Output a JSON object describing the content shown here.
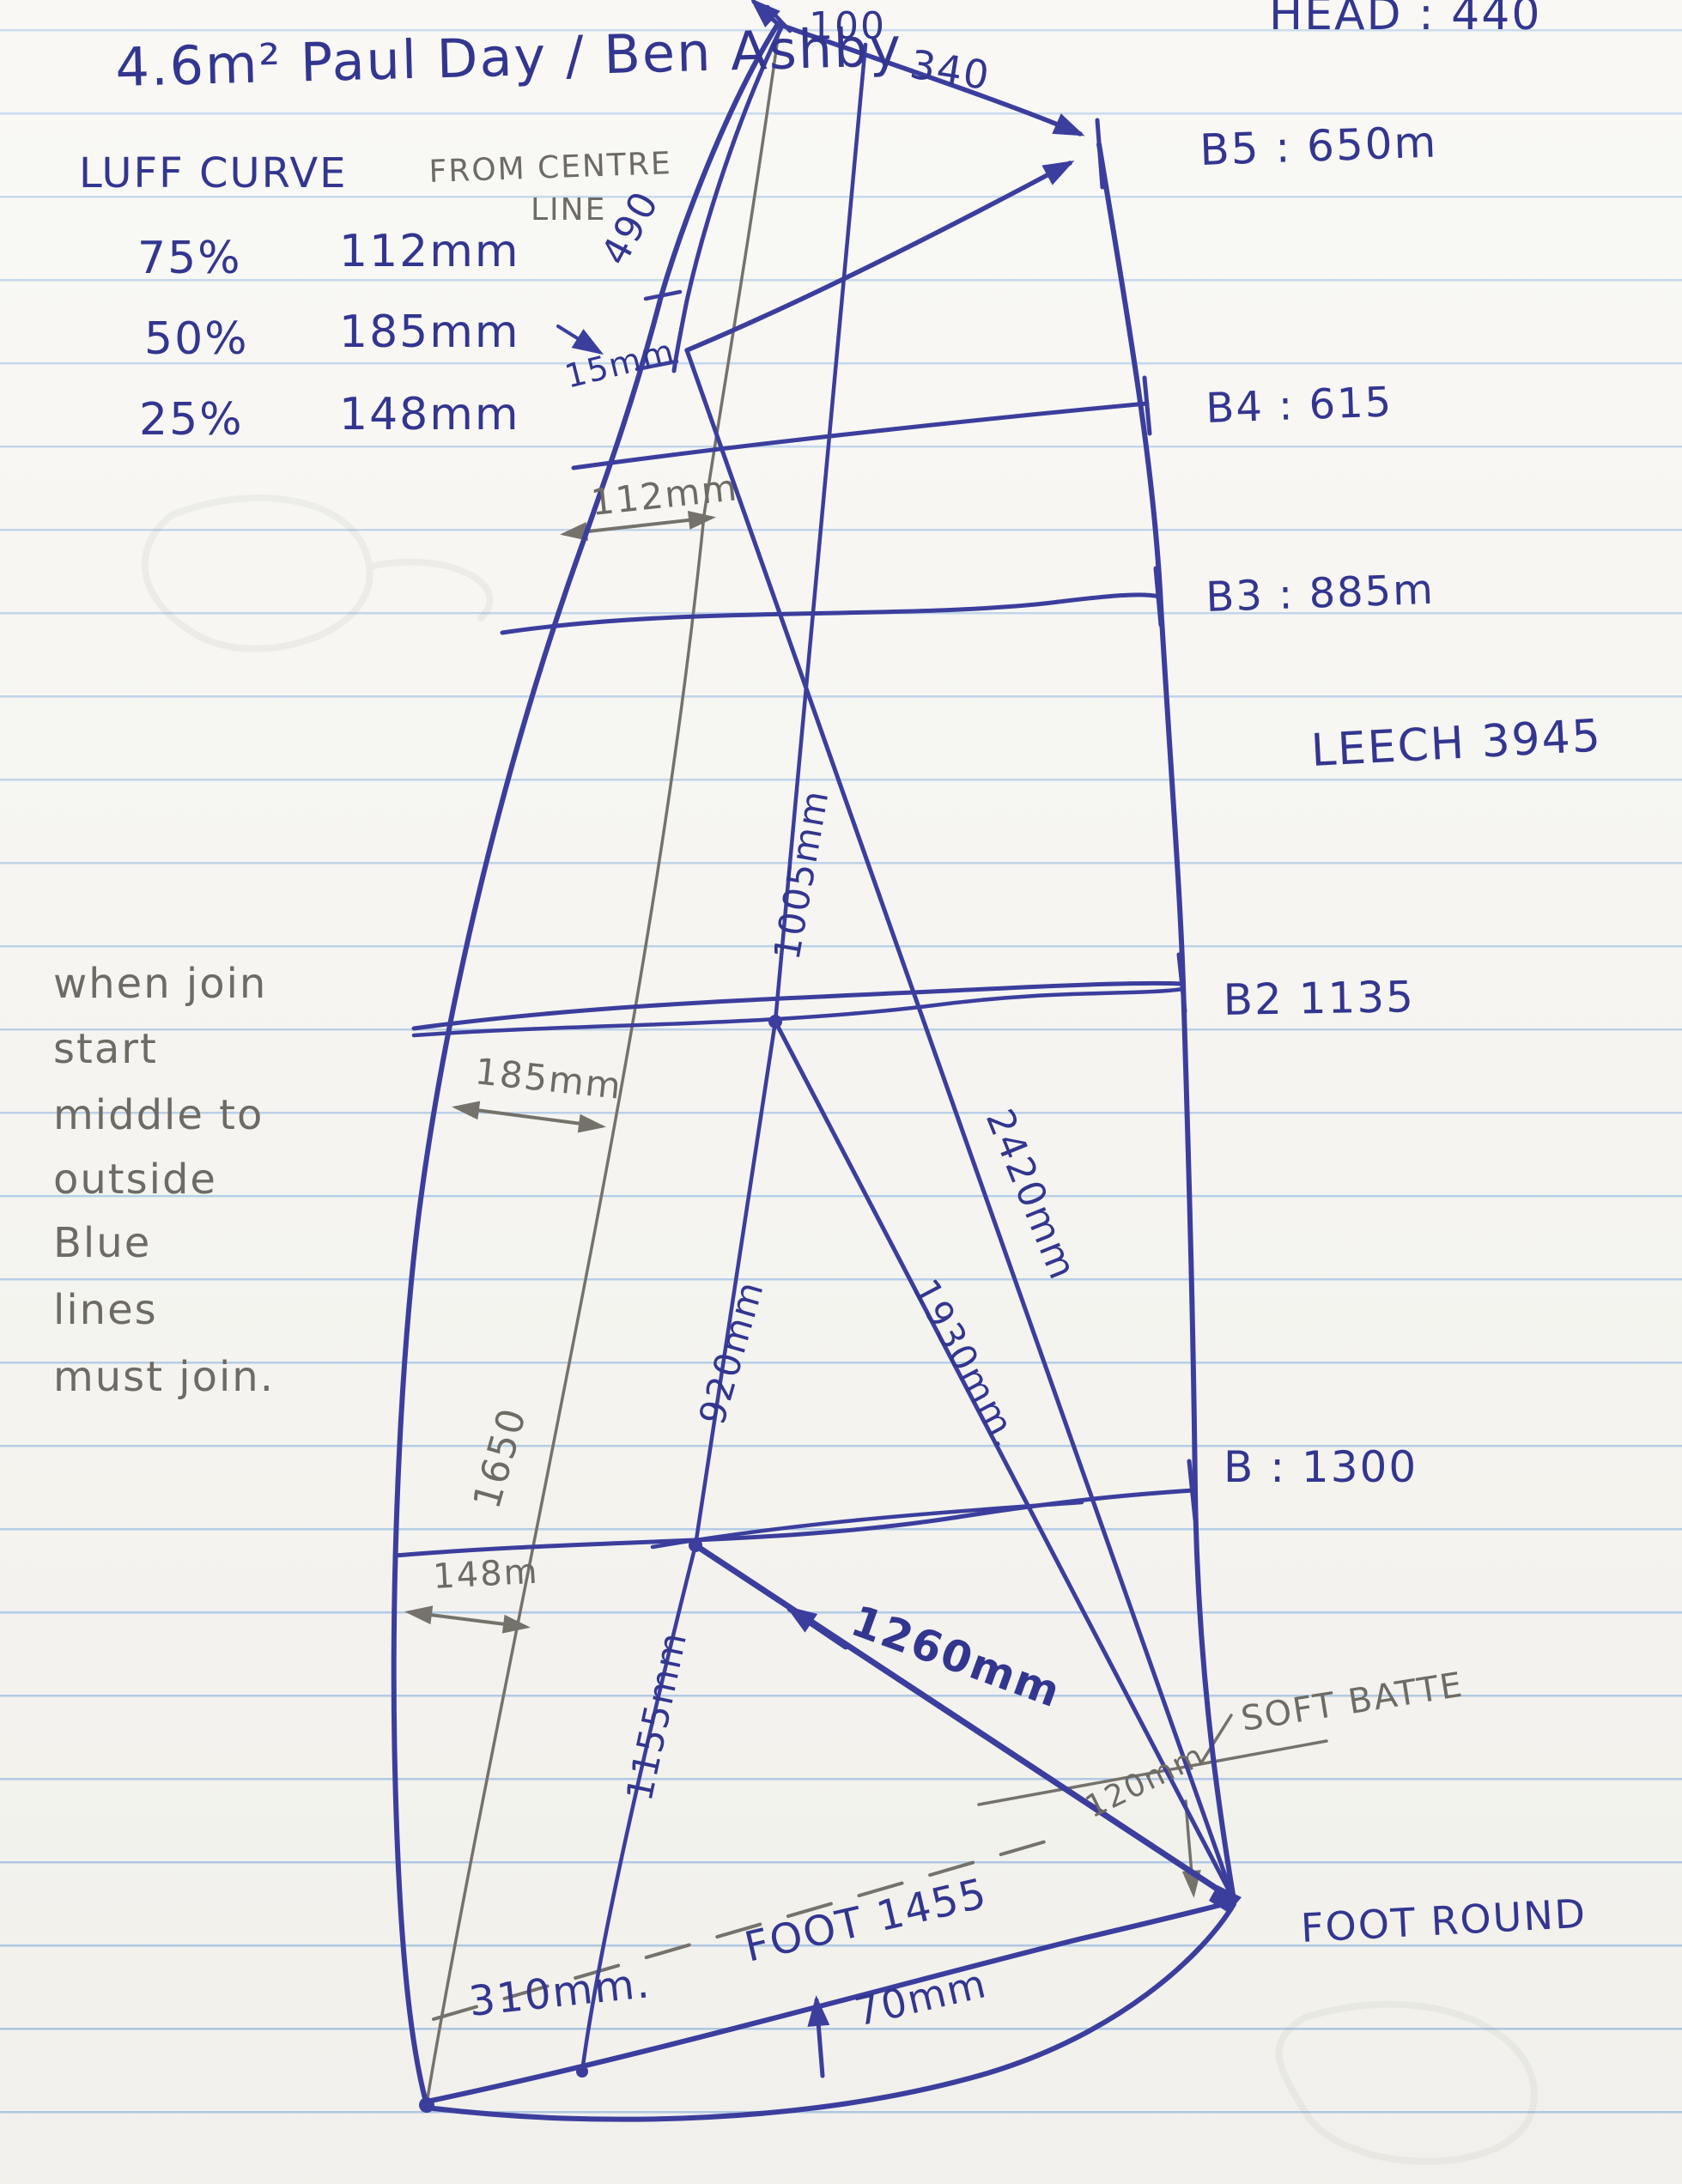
{
  "page": {
    "title": "4.6m²  Paul Day / Ben Ashby",
    "head_label": "HEAD : 440"
  },
  "luff_curve_table": {
    "heading": "LUFF  CURVE",
    "note_line1": "FROM CENTRE",
    "note_line2": "LINE",
    "rows": [
      {
        "pct": "75%",
        "value": "112mm"
      },
      {
        "pct": "50%",
        "value": "185mm"
      },
      {
        "pct": "25%",
        "value": "148mm"
      }
    ]
  },
  "sail": {
    "head_width": "100",
    "top_batten_length": "340",
    "luff_top_length": "490",
    "luff_offset": "15mm",
    "leech_label": "LEECH 3945",
    "battens": [
      {
        "label": "B5 : 650m"
      },
      {
        "label": "B4 : 615"
      },
      {
        "label": "B3 : 885m"
      },
      {
        "label": "B2  1135"
      },
      {
        "label": "B : 1300"
      }
    ],
    "measures": {
      "m112": "112mm",
      "m185": "185mm",
      "m148": "148m",
      "m1650": "1650",
      "m1005": "1005mm",
      "m2420": "2420mm",
      "m1930": "1930mm.",
      "m920": "920mm",
      "m1155": "1155mm",
      "m1260": "1260mm",
      "m120": "120mm",
      "m310": "310mm.",
      "m70": "70mm",
      "foot_length": "FOOT 1455",
      "foot_round": "FOOT ROUND",
      "soft_batten": "SOFT BATTE"
    }
  },
  "margin_notes": {
    "lines": [
      "when join",
      "start",
      "middle to",
      "outside",
      "Blue",
      "lines",
      "must join."
    ]
  }
}
